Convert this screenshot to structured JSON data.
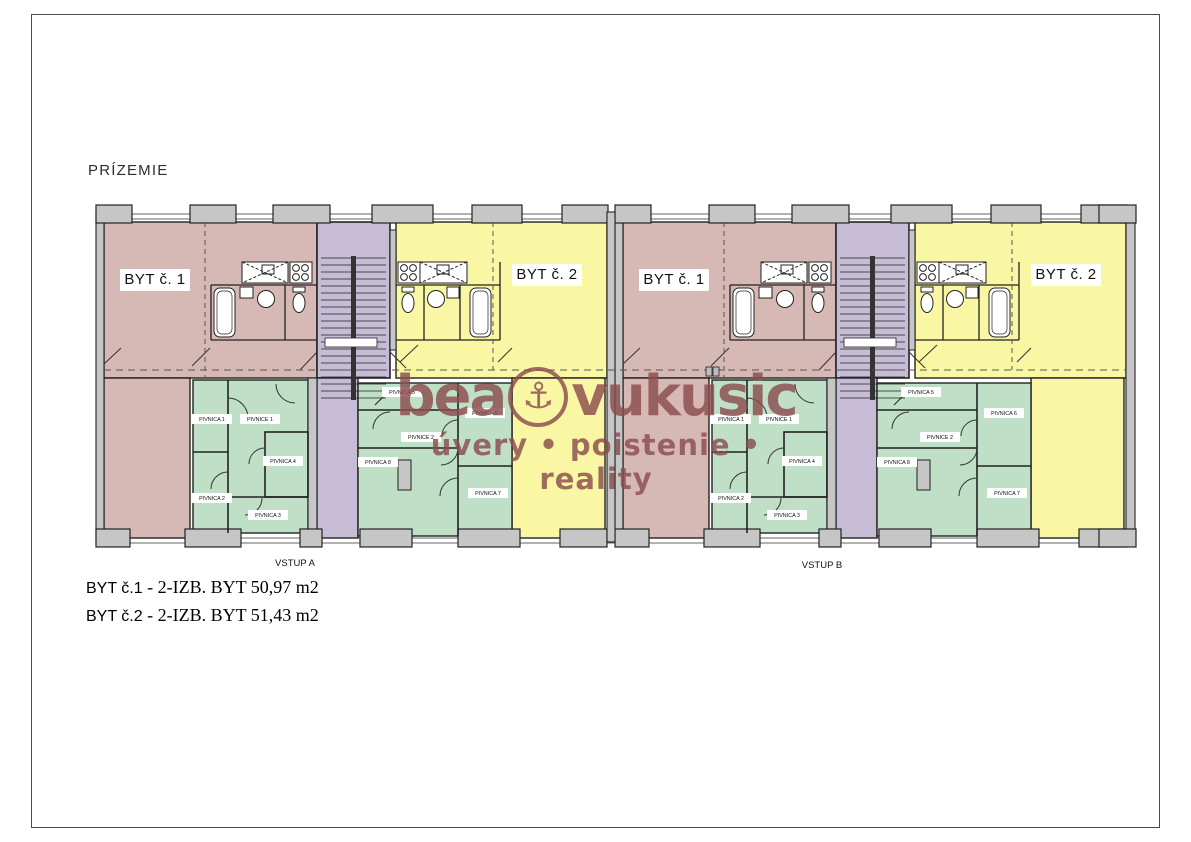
{
  "page": {
    "title": "PRÍZEMIE"
  },
  "plan": {
    "apartments": {
      "byt1": "BYT č. 1",
      "byt2": "BYT č. 2"
    },
    "entrances": {
      "a": "VSTUP A",
      "b": "VSTUP B"
    },
    "cellars": {
      "block1": {
        "r1": "PIVNICA 1",
        "c1": "PIVNICE 1",
        "r4": "PIVNICA 4",
        "r2": "PIVNICA 2",
        "r3": "PIVNICA 3"
      },
      "block2": {
        "r5": "PIVNICA 5",
        "r6": "PIVNICA 6",
        "c2": "PIVNICE 2",
        "r8": "PIVNICA 8",
        "r7": "PIVNICA 7"
      }
    },
    "colors": {
      "apartment1": "#d6b8b5",
      "apartment2": "#f9f7a3",
      "stairwell": "#c7bcd6",
      "cellar": "#c0dfc7",
      "wall": "#c6c6c6"
    }
  },
  "watermark": {
    "brand_left": "bea",
    "brand_right": "vukusic",
    "anchor_icon": "⚓",
    "tagline": "úvery • poistenie • reality",
    "color": "#8b4d4d"
  },
  "legend": {
    "separator": " - ",
    "items": [
      {
        "label": "BYT č.1",
        "desc": "2-IZB. BYT 50,97 m2"
      },
      {
        "label": "BYT č.2",
        "desc": "2-IZB. BYT 51,43 m2"
      }
    ]
  }
}
